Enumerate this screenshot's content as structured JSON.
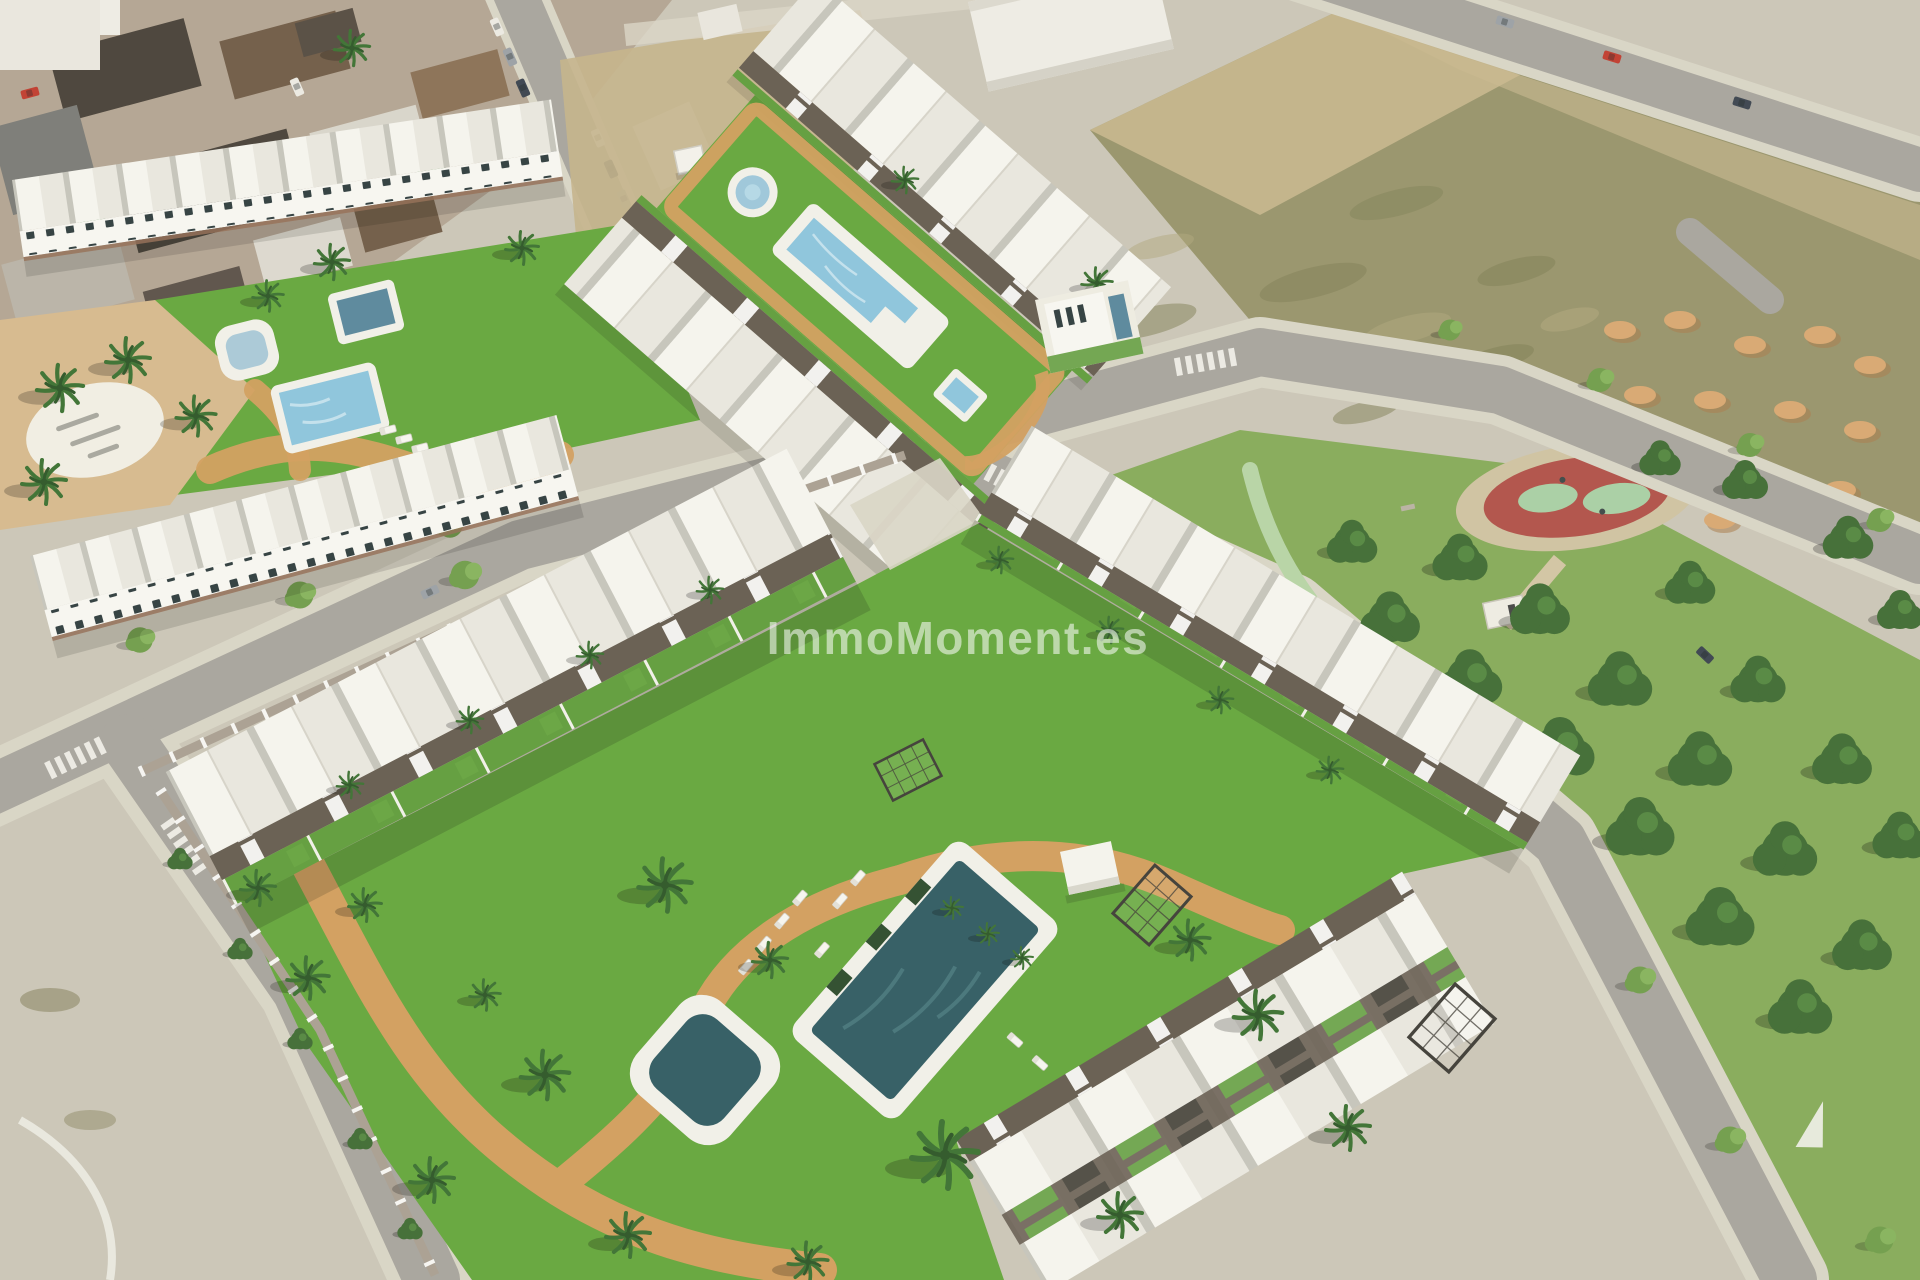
{
  "watermark": {
    "text": "ImmoMoment.es",
    "color": "#ffffff",
    "opacity": "0.55"
  },
  "colors": {
    "base": "#cbc6b8",
    "road": "#a7a49d",
    "sidewalk": "#d9d5c7",
    "dirt": "#97936b",
    "dirtdark": "#7d7b52",
    "lotsand": "#c9b88f",
    "sand": "#d6b98e",
    "mound": "#d9a771",
    "moundsh": "#aa7a4b",
    "grass": "#64a63c",
    "grasslight": "#76b94a",
    "gardenstrip": "#5f9c3c",
    "park": "#85aa59",
    "tree": "#3f6b33",
    "treelight": "#558a41",
    "ltreea": "#6f9c4a",
    "ltreeb": "#85b35c",
    "palm": "#3a7031",
    "palmdark": "#2c5526",
    "poollight": "#8cc4de",
    "pooldark": "#2f5a62",
    "poolmid": "#58869c",
    "deck": "#f2f1ea",
    "path": "#d29e5d",
    "roofwhite": "#f6f5f0",
    "roofshade": "#e9e7e0",
    "gap": "#c6c4bc",
    "facade": "#f8f7f3",
    "window": "#2e3b3e",
    "pergola": "#655b50",
    "wall": "#a99f92",
    "brick": "#8f6a52",
    "townbase": "#b3a493",
    "townroofdark": "#474038",
    "townroofbrown": "#6f5a46",
    "townrooflight": "#d9d5cc",
    "playred": "#b05048",
    "playgreen": "#a8cfa5",
    "playpath": "#cfc2a2",
    "bikelane": "#b7d4a6",
    "carred": "#c03a2e",
    "carwhite": "#eceae4",
    "cardark": "#39424e",
    "carsilver": "#9aa0a6"
  }
}
